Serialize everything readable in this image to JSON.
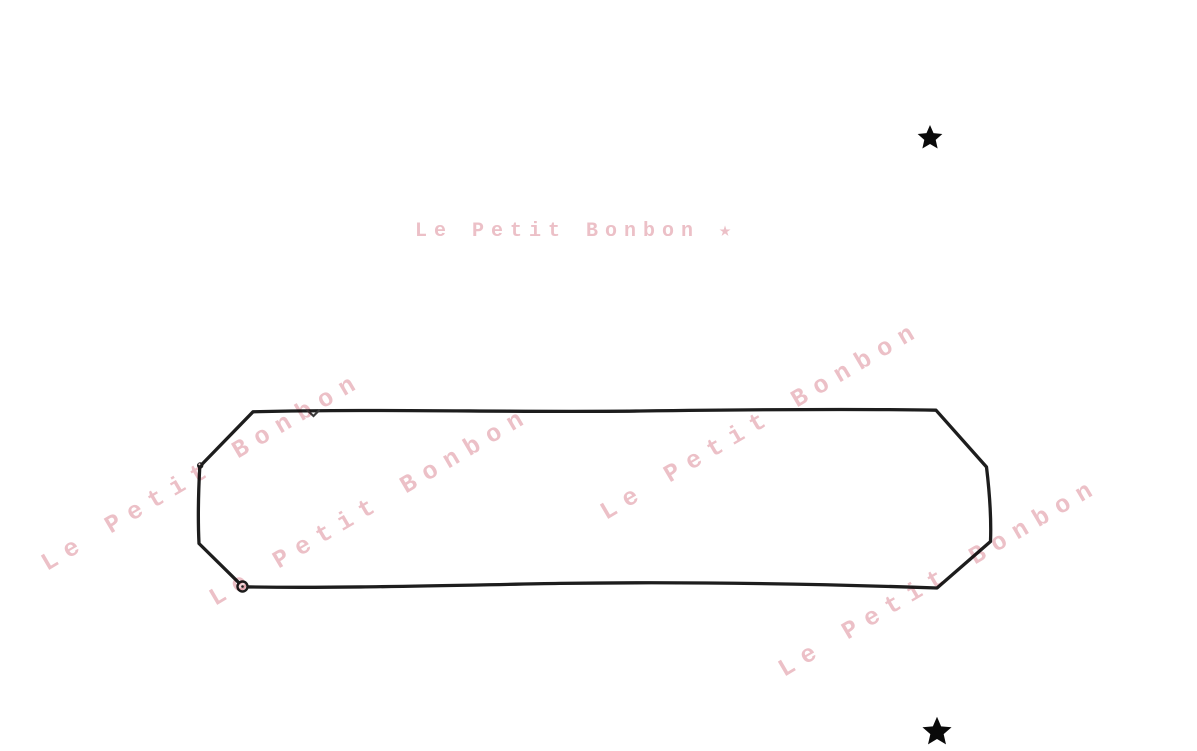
{
  "canvas": {
    "width": 1197,
    "height": 751,
    "background_color": "#ffffff"
  },
  "watermark": {
    "diagonal_text": "Le Petit Bonbon",
    "horizontal_text": "Le Petit Bonbon ★",
    "color": "#ecc0c7",
    "diagonal_count": 4,
    "angle_degrees": -30.5
  },
  "frame": {
    "shape": "hand-drawn elongated octagon",
    "stroke_color": "#1d1d1d"
  },
  "stars": {
    "color": "#0a0a0a",
    "count": 2
  }
}
